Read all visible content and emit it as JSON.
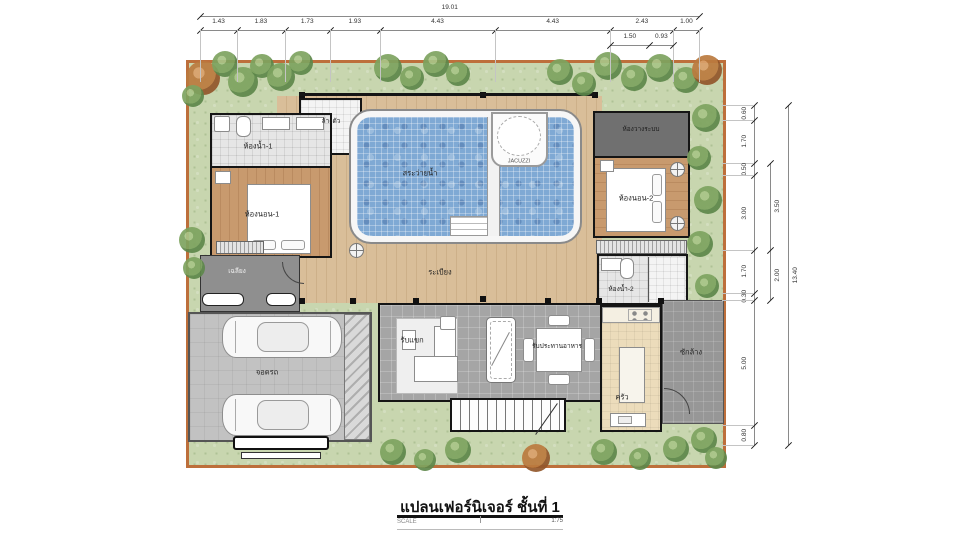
{
  "title": {
    "main": "แปลนเฟอร์นิเจอร์ ชั้นที่ 1",
    "scale_label": "SCALE",
    "scale_value": "1:75"
  },
  "rooms": {
    "bath1": "ห้องน้ำ-1",
    "bed1": "ห้องนอน-1",
    "shower": "ล้างตัว",
    "pool": "สระว่ายน้ำ",
    "jacuzzi": "JACUZZI",
    "system": "ห้องวางระบบ",
    "bed2": "ห้องนอน-2",
    "bath2": "ห้องน้ำ-2",
    "terrace": "ระเบียง",
    "porch": "เฉลียง",
    "garage": "จอดรถ",
    "living": "รับแขก",
    "dining": "รับประทานอาหาร",
    "kitchen": "ครัว",
    "laundry": "ซักล้าง"
  },
  "dimensions": {
    "top_total": "19.01",
    "top_segments": [
      "1.43",
      "1.83",
      "1.73",
      "1.93",
      "4.43",
      "4.43",
      "2.43",
      "1.00"
    ],
    "top_sub": [
      "1.50",
      "0.93"
    ],
    "right_segments": [
      "0.60",
      "1.70",
      "0.50",
      "3.00",
      "1.70",
      "0.30",
      "5.00",
      "0.80"
    ],
    "right_mid": [
      "3.50",
      "2.00"
    ],
    "right_total": "13.40"
  },
  "colors": {
    "fence": "#bd6f3b",
    "grass": "#c8d6af",
    "pool_water": "#7fa9d4",
    "deck_wood": "#d9be99",
    "room_wood": "#c89a6e",
    "wall": "#151515"
  }
}
